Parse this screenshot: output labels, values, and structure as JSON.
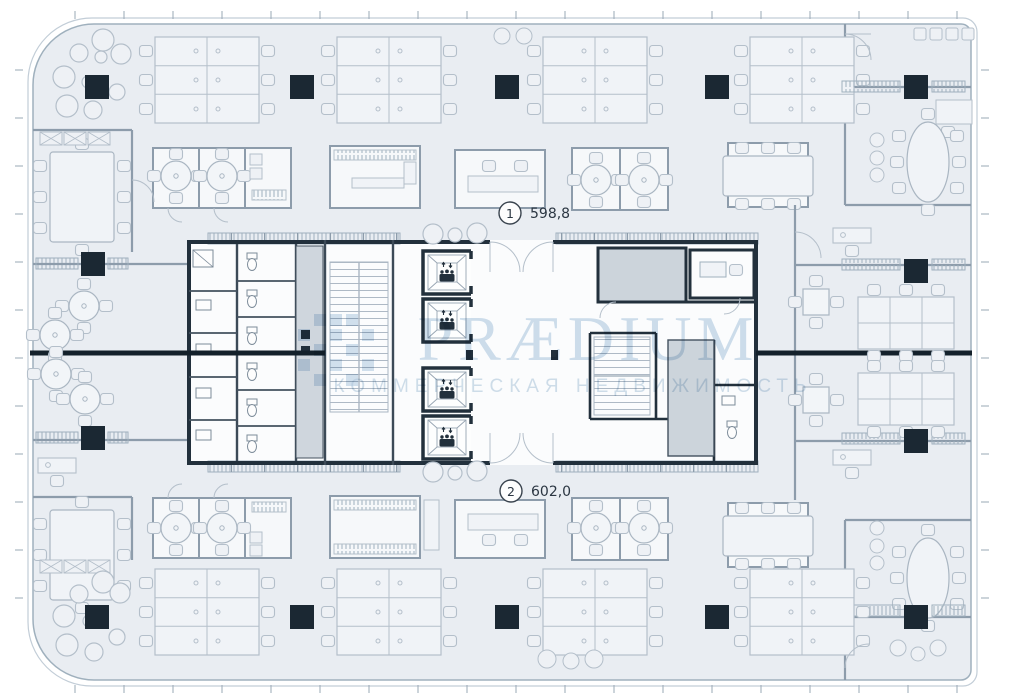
{
  "plan": {
    "units": [
      {
        "marker": "1",
        "area_label": "598,8"
      },
      {
        "marker": "2",
        "area_label": "602,0"
      }
    ]
  },
  "watermark": {
    "brand": "PRÆDIUM",
    "tagline": "КОММЕРЧЕСКАЯ НЕДВИЖИМОСТЬ"
  },
  "colors": {
    "floor": "#e9edf2",
    "boundary": "#9fb0bd",
    "wall_dark": "#22303c",
    "wall_medium": "#8d9cab",
    "furniture": "#b4bfca",
    "column": "#1b2833",
    "shaft_fill": "#ccd4db",
    "demising_line": "#14212b",
    "watermark": "#a9c5dd",
    "label_text": "#2b3642"
  },
  "icons": {
    "elevator": "elevator-icon",
    "staircase": "staircase-icon",
    "toilet": "toilet-icon"
  }
}
